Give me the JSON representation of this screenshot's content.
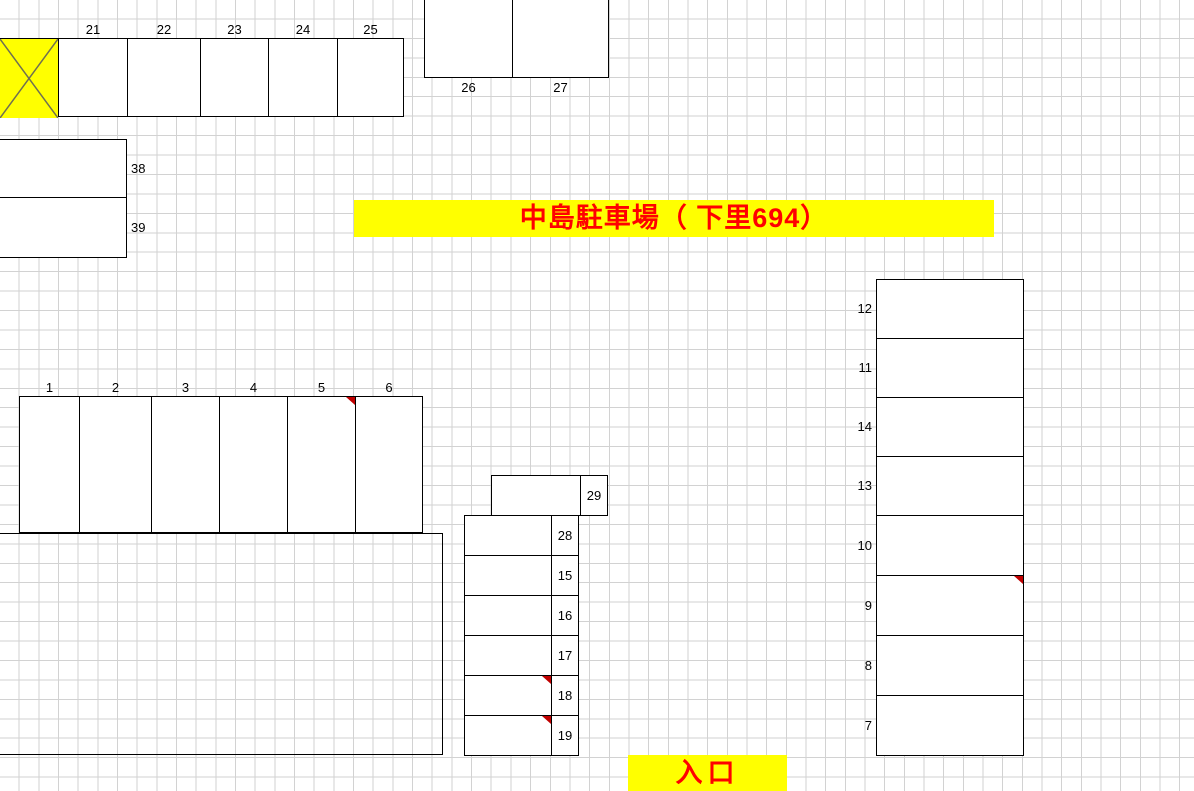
{
  "title_banner": {
    "text": "中島駐車場（ 下里694）",
    "bg": "#ffff00",
    "color": "#ff0000"
  },
  "entrance_banner": {
    "text": "入口",
    "bg": "#ffff00",
    "color": "#ff0000"
  },
  "blocked_cell": {
    "bg": "#ffff00",
    "mark": "x-cross",
    "mark_color": "#6f6f52"
  },
  "colors": {
    "line": "#000000",
    "grid": "#d2d2d2",
    "note_marker": "#c00000"
  },
  "groups": {
    "top_row": {
      "spots": [
        "21",
        "22",
        "23",
        "24",
        "25"
      ],
      "marked": []
    },
    "upper_block": {
      "spots": [
        "26",
        "27"
      ],
      "marked": []
    },
    "left_block": {
      "spots": [
        "38",
        "39"
      ],
      "marked": []
    },
    "row_main": {
      "spots": [
        "1",
        "2",
        "3",
        "4",
        "5",
        "6"
      ],
      "marked": [
        "5"
      ]
    },
    "mid_overhang": {
      "spots": [
        "29"
      ],
      "marked": []
    },
    "mid_column": {
      "spots": [
        "28",
        "15",
        "16",
        "17",
        "18",
        "19"
      ],
      "marked": [
        "18",
        "19"
      ]
    },
    "right_column": {
      "spots": [
        "12",
        "11",
        "14",
        "13",
        "10",
        "9",
        "8",
        "7"
      ],
      "marked": [
        "9"
      ]
    }
  }
}
